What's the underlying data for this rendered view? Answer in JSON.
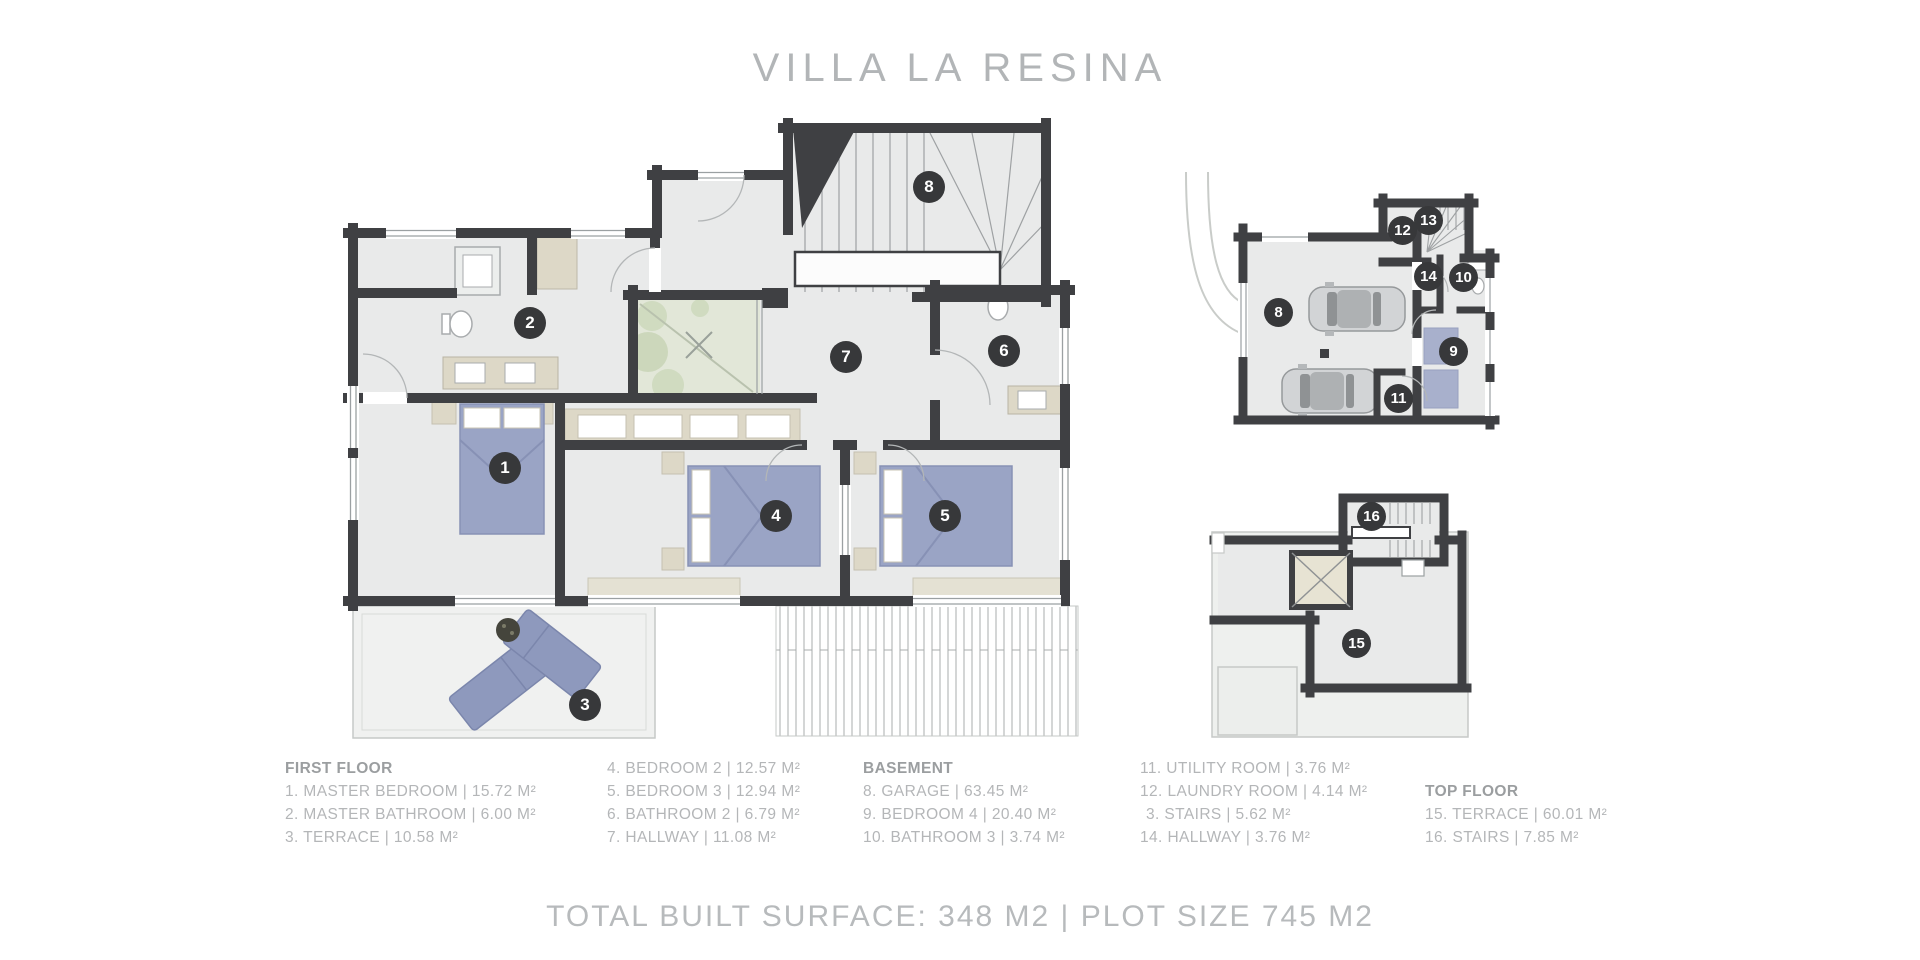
{
  "title": "VILLA LA RESINA",
  "footer": "TOTAL BUILT SURFACE: 348 M2 | PLOT SIZE 745 M2",
  "legend": {
    "columns": [
      {
        "title": "FIRST FLOOR",
        "items": [
          "1. MASTER BEDROOM | 15.72 M²",
          "2. MASTER BATHROOM | 6.00 M²",
          "3. TERRACE | 10.58 M²"
        ]
      },
      {
        "title": "",
        "items": [
          "4. BEDROOM 2 | 12.57 M²",
          "5. BEDROOM 3 | 12.94 M²",
          "6. BATHROOM 2 | 6.79 M²",
          "7. HALLWAY | 11.08 M²"
        ]
      },
      {
        "title": "BASEMENT",
        "items": [
          "8. GARAGE | 63.45 M²",
          "9. BEDROOM 4 | 20.40 M²",
          "10. BATHROOM 3 | 3.74 M²"
        ]
      },
      {
        "title": "",
        "items": [
          "11. UTILITY ROOM | 3.76 M²",
          "12. LAUNDRY ROOM | 4.14 M²",
          "3. STAIRS | 5.62 M²",
          "14. HALLWAY | 3.76 M²"
        ]
      },
      {
        "title": "TOP FLOOR",
        "items": [
          "15. TERRACE | 60.01 M²",
          "16. STAIRS | 7.85 M²"
        ]
      }
    ]
  },
  "plans": {
    "first_floor": {
      "badges": [
        "1",
        "2",
        "3",
        "4",
        "5",
        "6",
        "7",
        "8"
      ]
    },
    "basement": {
      "badges": [
        "8",
        "9",
        "10",
        "11",
        "12",
        "13",
        "14"
      ]
    },
    "top_floor": {
      "badges": [
        "15",
        "16"
      ]
    }
  },
  "colors": {
    "wall": "#3f4043",
    "floor": "#e9eaea",
    "courtyard": "#e2e7d8",
    "bed": "#9aa4c5",
    "beige": "#ddd8c7",
    "badge": "#37383a",
    "text": "#b4b6b8"
  }
}
